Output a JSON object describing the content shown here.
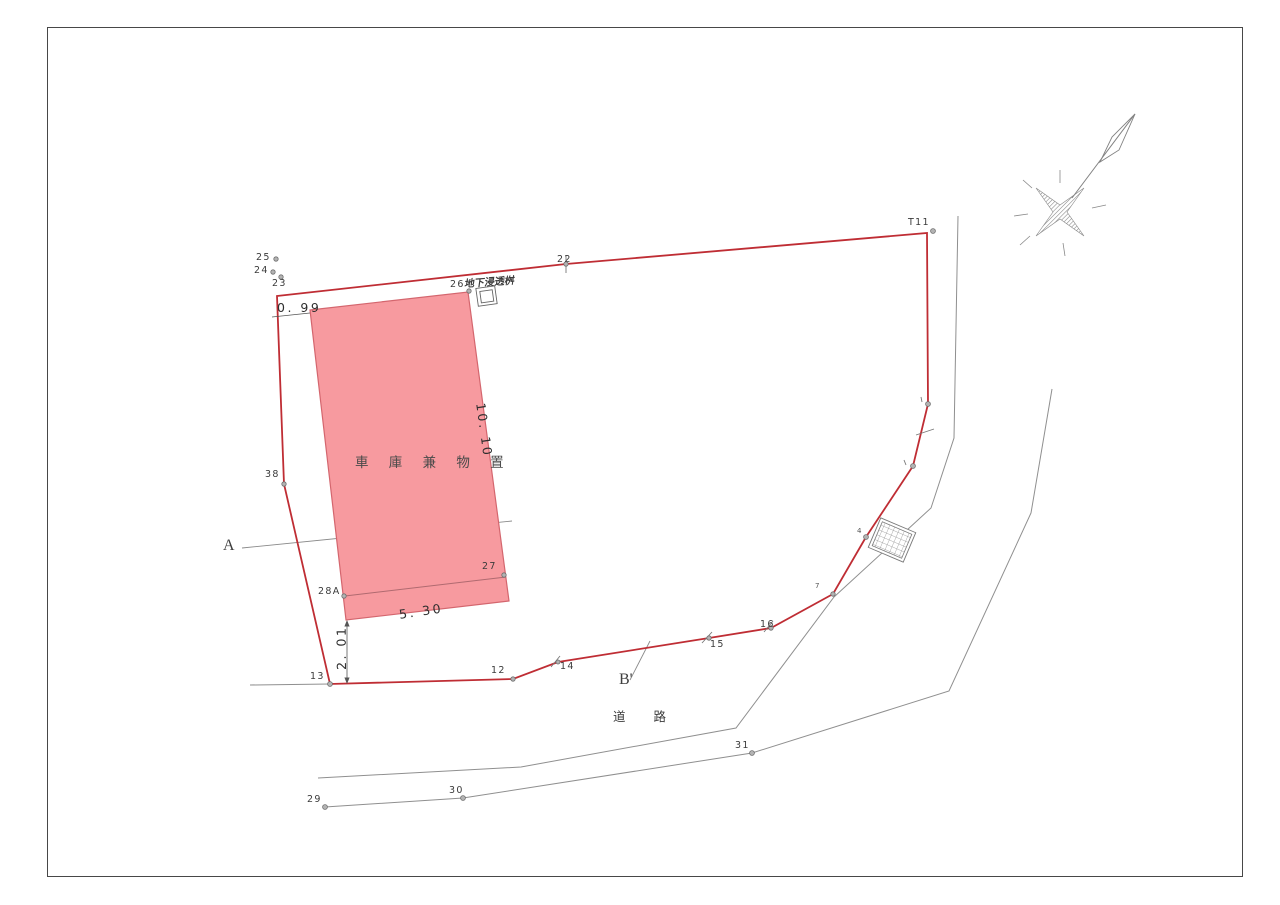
{
  "labels": {
    "building": "車 庫 兼 物 置",
    "road": "道 路",
    "infiltration": "地下浸透桝",
    "section_a": "A",
    "section_b": "B'"
  },
  "dimensions": {
    "left_offset": "0. 99",
    "building_height": "10. 10",
    "building_width": "5. 30",
    "south_offset": "2. 01"
  },
  "points": {
    "p12": "12",
    "p13": "13",
    "p14": "14",
    "p15": "15",
    "p16": "16",
    "p22": "22",
    "p23": "23",
    "p24": "24",
    "p25": "25",
    "p26": "26",
    "p27": "27",
    "p28a": "28A",
    "p29": "29",
    "p30": "30",
    "p31": "31",
    "p38": "38",
    "p4": "4",
    "p7": "7",
    "t11": "T11"
  },
  "colors": {
    "boundary_red": "#bf2d34",
    "building_fill": "#f79a9f",
    "building_edge": "#d4666e",
    "survey_gray": "#8f8f8f",
    "text": "#3b3b3b"
  }
}
